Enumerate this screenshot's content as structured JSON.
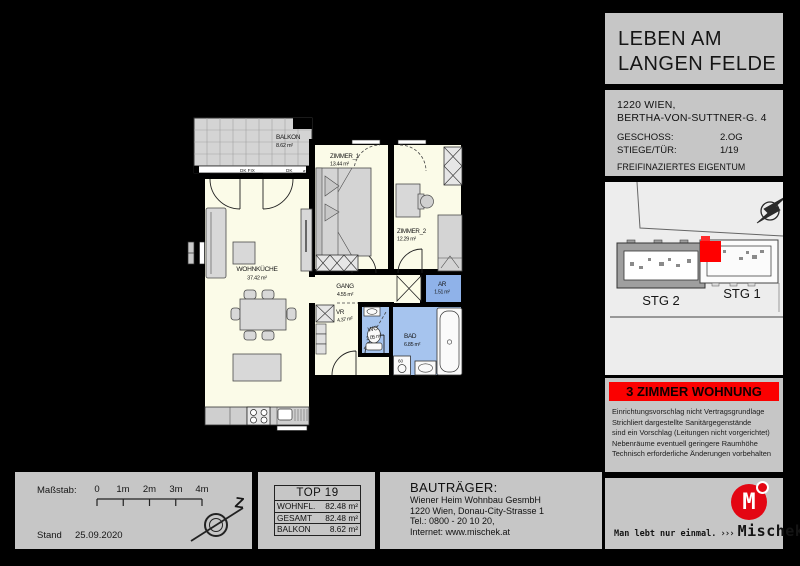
{
  "header": {
    "title_line1": "LEBEN AM",
    "title_line2": "LANGEN FELDE",
    "address_line1": "1220 WIEN,",
    "address_line2": "BERTHA-VON-SUTTNER-G. 4",
    "geschoss_label": "GESCHOSS:",
    "geschoss_value": "2.OG",
    "stiege_label": "STIEGE/TÜR:",
    "stiege_value": "1/19",
    "financing": "FREIFINAZIERTES EIGENTUM"
  },
  "site_plan": {
    "stg2_label": "STG 2",
    "stg1_label": "STG 1"
  },
  "banner": {
    "text": "3 ZIMMER WOHNUNG"
  },
  "disclaimer": {
    "lines": [
      "Einrichtungsvorschlag nicht Vertragsgrundlage",
      "Strichliert dargestellte Sanitärgegenstände",
      "sind ein Vorschlag (Leitungen nicht vorgerichtet)",
      "Nebenräume eventuell geringere Raumhöhe",
      "Technisch erforderliche Änderungen vorbehalten"
    ]
  },
  "plan": {
    "rooms": {
      "balkon": {
        "name": "BALKON",
        "area": "8.62 m²"
      },
      "zimmer1": {
        "name": "ZIMMER_1",
        "area": "13.44 m²"
      },
      "zimmer2": {
        "name": "ZIMMER_2",
        "area": "12.29 m²"
      },
      "wohnkueche": {
        "name": "WOHNKÜCHE",
        "area": "37.42 m²"
      },
      "gang": {
        "name": "GANG",
        "area": "4.55 m²"
      },
      "ar": {
        "name": "AR",
        "area": "1.51 m²"
      },
      "vr": {
        "name": "VR",
        "area": "4.37 m²"
      },
      "wc": {
        "name": "WC",
        "area": "2.05 m²"
      },
      "bad": {
        "name": "BAD",
        "area": "6.85 m²"
      }
    },
    "marks": {
      "dk_fix": "DK FIX",
      "dk": "DK",
      "vent": "⌀",
      "washer": "60"
    }
  },
  "scalebar": {
    "label": "Maßstab:",
    "ticks": [
      "0",
      "1m",
      "2m",
      "3m",
      "4m"
    ],
    "stand_label": "Stand",
    "stand_date": "25.09.2020",
    "north_letter": "Z"
  },
  "top_table": {
    "title": "TOP 19",
    "rows": [
      {
        "label": "WOHNFL.",
        "value": "82.48 m²"
      },
      {
        "label": "GESAMT",
        "value": "82.48 m²"
      },
      {
        "label": "BALKON",
        "value": "8.62 m²"
      }
    ]
  },
  "developer": {
    "heading": "BAUTRÄGER:",
    "lines": [
      "Wiener Heim Wohnbau GesmbH",
      "1220 Wien, Donau-City-Strasse 1",
      "Tel.: 0800 - 20 10 20,",
      "Internet: www.mischek.at"
    ]
  },
  "brand": {
    "logo_letter": "M",
    "tagline": "Man lebt nur einmal.",
    "chevrons": "›››",
    "name": "Mischek"
  },
  "colors": {
    "accent_red": "#fb0000",
    "logo_red": "#e30613",
    "room_cream": "#fbfbe8",
    "room_blue": "#a6c4ee",
    "room_blue_dark": "#8fb2e9"
  }
}
